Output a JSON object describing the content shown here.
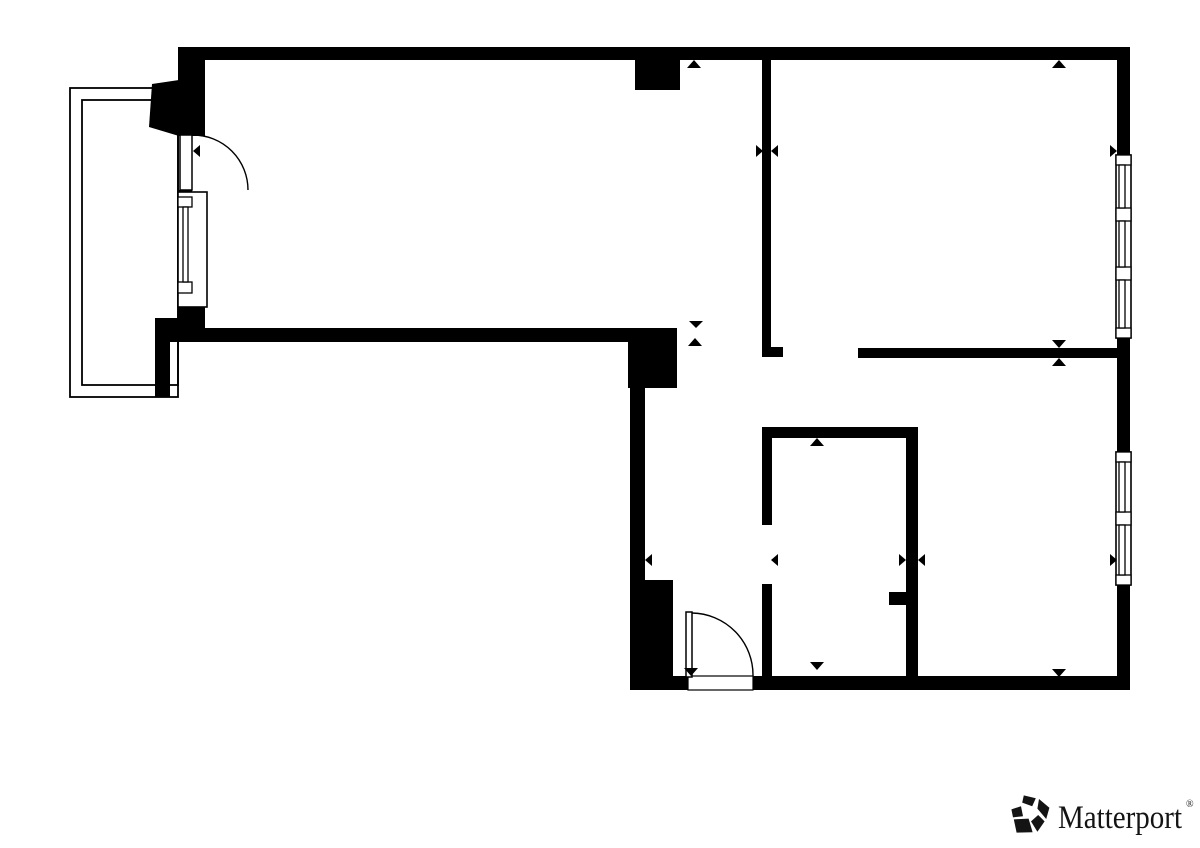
{
  "canvas": {
    "width": 1200,
    "height": 848,
    "background": "#ffffff"
  },
  "colors": {
    "wall": "#000000",
    "line": "#000000",
    "fill": "#ffffff",
    "logo_text": "#141414"
  },
  "logo": {
    "text": "Matterport",
    "trademark": "®"
  },
  "floorplan": {
    "balcony": {
      "outer": [
        70,
        88,
        108,
        309
      ],
      "inner": [
        82,
        100,
        96,
        285
      ]
    },
    "walls": [
      {
        "name": "top-wall",
        "r": [
          178,
          47,
          952,
          13
        ]
      },
      {
        "name": "left-wall-upper",
        "r": [
          178,
          47,
          27,
          89
        ]
      },
      {
        "name": "door-lintel",
        "r": [
          178,
          190,
          14,
          8
        ]
      },
      {
        "name": "left-wall-lower",
        "r": [
          178,
          294,
          27,
          48
        ]
      },
      {
        "name": "balcony-junction-block",
        "r": [
          155,
          318,
          50,
          24
        ]
      },
      {
        "name": "balcony-pier",
        "r": [
          155,
          318,
          15,
          79
        ]
      },
      {
        "name": "living-room-bottom-wall",
        "r": [
          155,
          328,
          522,
          14
        ]
      },
      {
        "name": "hall-corner-block",
        "r": [
          628,
          328,
          49,
          60
        ]
      },
      {
        "name": "hall-left-wall",
        "r": [
          630,
          388,
          15,
          192
        ]
      },
      {
        "name": "entry-left-block",
        "r": [
          630,
          580,
          43,
          110
        ]
      },
      {
        "name": "bottom-wall-left-of-door",
        "r": [
          630,
          676,
          58,
          14
        ]
      },
      {
        "name": "bottom-wall-right-of-door",
        "r": [
          753,
          676,
          377,
          14
        ]
      },
      {
        "name": "right-wall-upper",
        "r": [
          1117,
          60,
          13,
          95
        ]
      },
      {
        "name": "right-wall-middle",
        "r": [
          1117,
          338,
          13,
          114
        ]
      },
      {
        "name": "right-wall-lower",
        "r": [
          1117,
          585,
          13,
          105
        ]
      },
      {
        "name": "top-wall-column",
        "r": [
          635,
          59,
          45,
          31
        ]
      },
      {
        "name": "bedroom-divider-wall",
        "r": [
          762,
          59,
          9,
          298
        ]
      },
      {
        "name": "bedroom-divider-foot",
        "r": [
          762,
          347,
          21,
          10
        ]
      },
      {
        "name": "rooms-divider-wall",
        "r": [
          858,
          348,
          259,
          10
        ]
      },
      {
        "name": "bathroom-top-wall",
        "r": [
          762,
          427,
          156,
          11
        ]
      },
      {
        "name": "bathroom-left-wall-upper",
        "r": [
          762,
          438,
          10,
          87
        ]
      },
      {
        "name": "bathroom-left-wall-lower",
        "r": [
          762,
          584,
          10,
          93
        ]
      },
      {
        "name": "bathroom-right-wall",
        "r": [
          906,
          438,
          12,
          239
        ]
      },
      {
        "name": "bathroom-wall-stub",
        "r": [
          889,
          592,
          17,
          13
        ]
      }
    ],
    "polygons": [
      {
        "name": "angled-wall",
        "points": "152,84 179,80 179,136 149,127"
      }
    ],
    "windows": [
      {
        "name": "left-window",
        "box": [
          178,
          192,
          29,
          115
        ],
        "panels": [
          [
            178,
            197,
            14,
            10
          ],
          [
            178,
            282,
            14,
            11
          ]
        ],
        "glass": [
          [
            183,
            207,
            5,
            75
          ]
        ]
      },
      {
        "name": "right-upper-window",
        "box": [
          1116,
          155,
          15,
          183
        ],
        "panels": [
          [
            1116,
            155,
            15,
            10
          ],
          [
            1116,
            208,
            15,
            13
          ],
          [
            1116,
            267,
            15,
            13
          ],
          [
            1116,
            328,
            15,
            10
          ]
        ],
        "glass": [
          [
            1119,
            165,
            6,
            43
          ],
          [
            1119,
            221,
            6,
            46
          ],
          [
            1119,
            280,
            6,
            48
          ]
        ]
      },
      {
        "name": "right-lower-window",
        "box": [
          1116,
          452,
          15,
          133
        ],
        "panels": [
          [
            1116,
            452,
            15,
            10
          ],
          [
            1116,
            512,
            15,
            13
          ],
          [
            1116,
            575,
            15,
            10
          ]
        ],
        "glass": [
          [
            1119,
            462,
            6,
            50
          ],
          [
            1119,
            525,
            6,
            50
          ]
        ]
      }
    ],
    "doors": [
      {
        "name": "balcony-door",
        "leaf": [
          180,
          135,
          12,
          55
        ],
        "arc": "M 193 135 A 55 55 0 0 1 248 190"
      },
      {
        "name": "entry-door",
        "leaf": [
          686,
          612,
          6,
          65
        ],
        "arc": "M 692 613 A 62 62 0 0 1 753 676",
        "threshold": [
          688,
          676,
          65,
          14
        ]
      }
    ],
    "markers": [
      {
        "dir": "up",
        "points": "694,60 687,68 701,68"
      },
      {
        "dir": "up",
        "points": "1059,60 1052,68 1066,68"
      },
      {
        "dir": "down",
        "points": "696,328 689,321 703,321"
      },
      {
        "dir": "up",
        "points": "695,338 688,346 702,346"
      },
      {
        "dir": "down",
        "points": "1059,348 1052,340 1066,340"
      },
      {
        "dir": "up",
        "points": "1059,358 1052,366 1066,366"
      },
      {
        "dir": "up",
        "points": "817,438 810,446 824,446"
      },
      {
        "dir": "down",
        "points": "817,670 810,662 824,662"
      },
      {
        "dir": "down",
        "points": "691,676 684,668 698,668"
      },
      {
        "dir": "down",
        "points": "1059,677 1052,669 1066,669"
      },
      {
        "dir": "left",
        "points": "193,151 200,145 200,157"
      },
      {
        "dir": "right",
        "points": "763,151 756,145 756,157"
      },
      {
        "dir": "left",
        "points": "771,151 778,145 778,157"
      },
      {
        "dir": "right",
        "points": "1117,151 1110,145 1110,157"
      },
      {
        "dir": "left",
        "points": "645,560 652,554 652,566"
      },
      {
        "dir": "left",
        "points": "771,560 778,554 778,566"
      },
      {
        "dir": "right",
        "points": "906,560 899,554 899,566"
      },
      {
        "dir": "left",
        "points": "918,560 925,554 925,566"
      },
      {
        "dir": "right",
        "points": "1117,560 1110,554 1110,566"
      }
    ]
  }
}
